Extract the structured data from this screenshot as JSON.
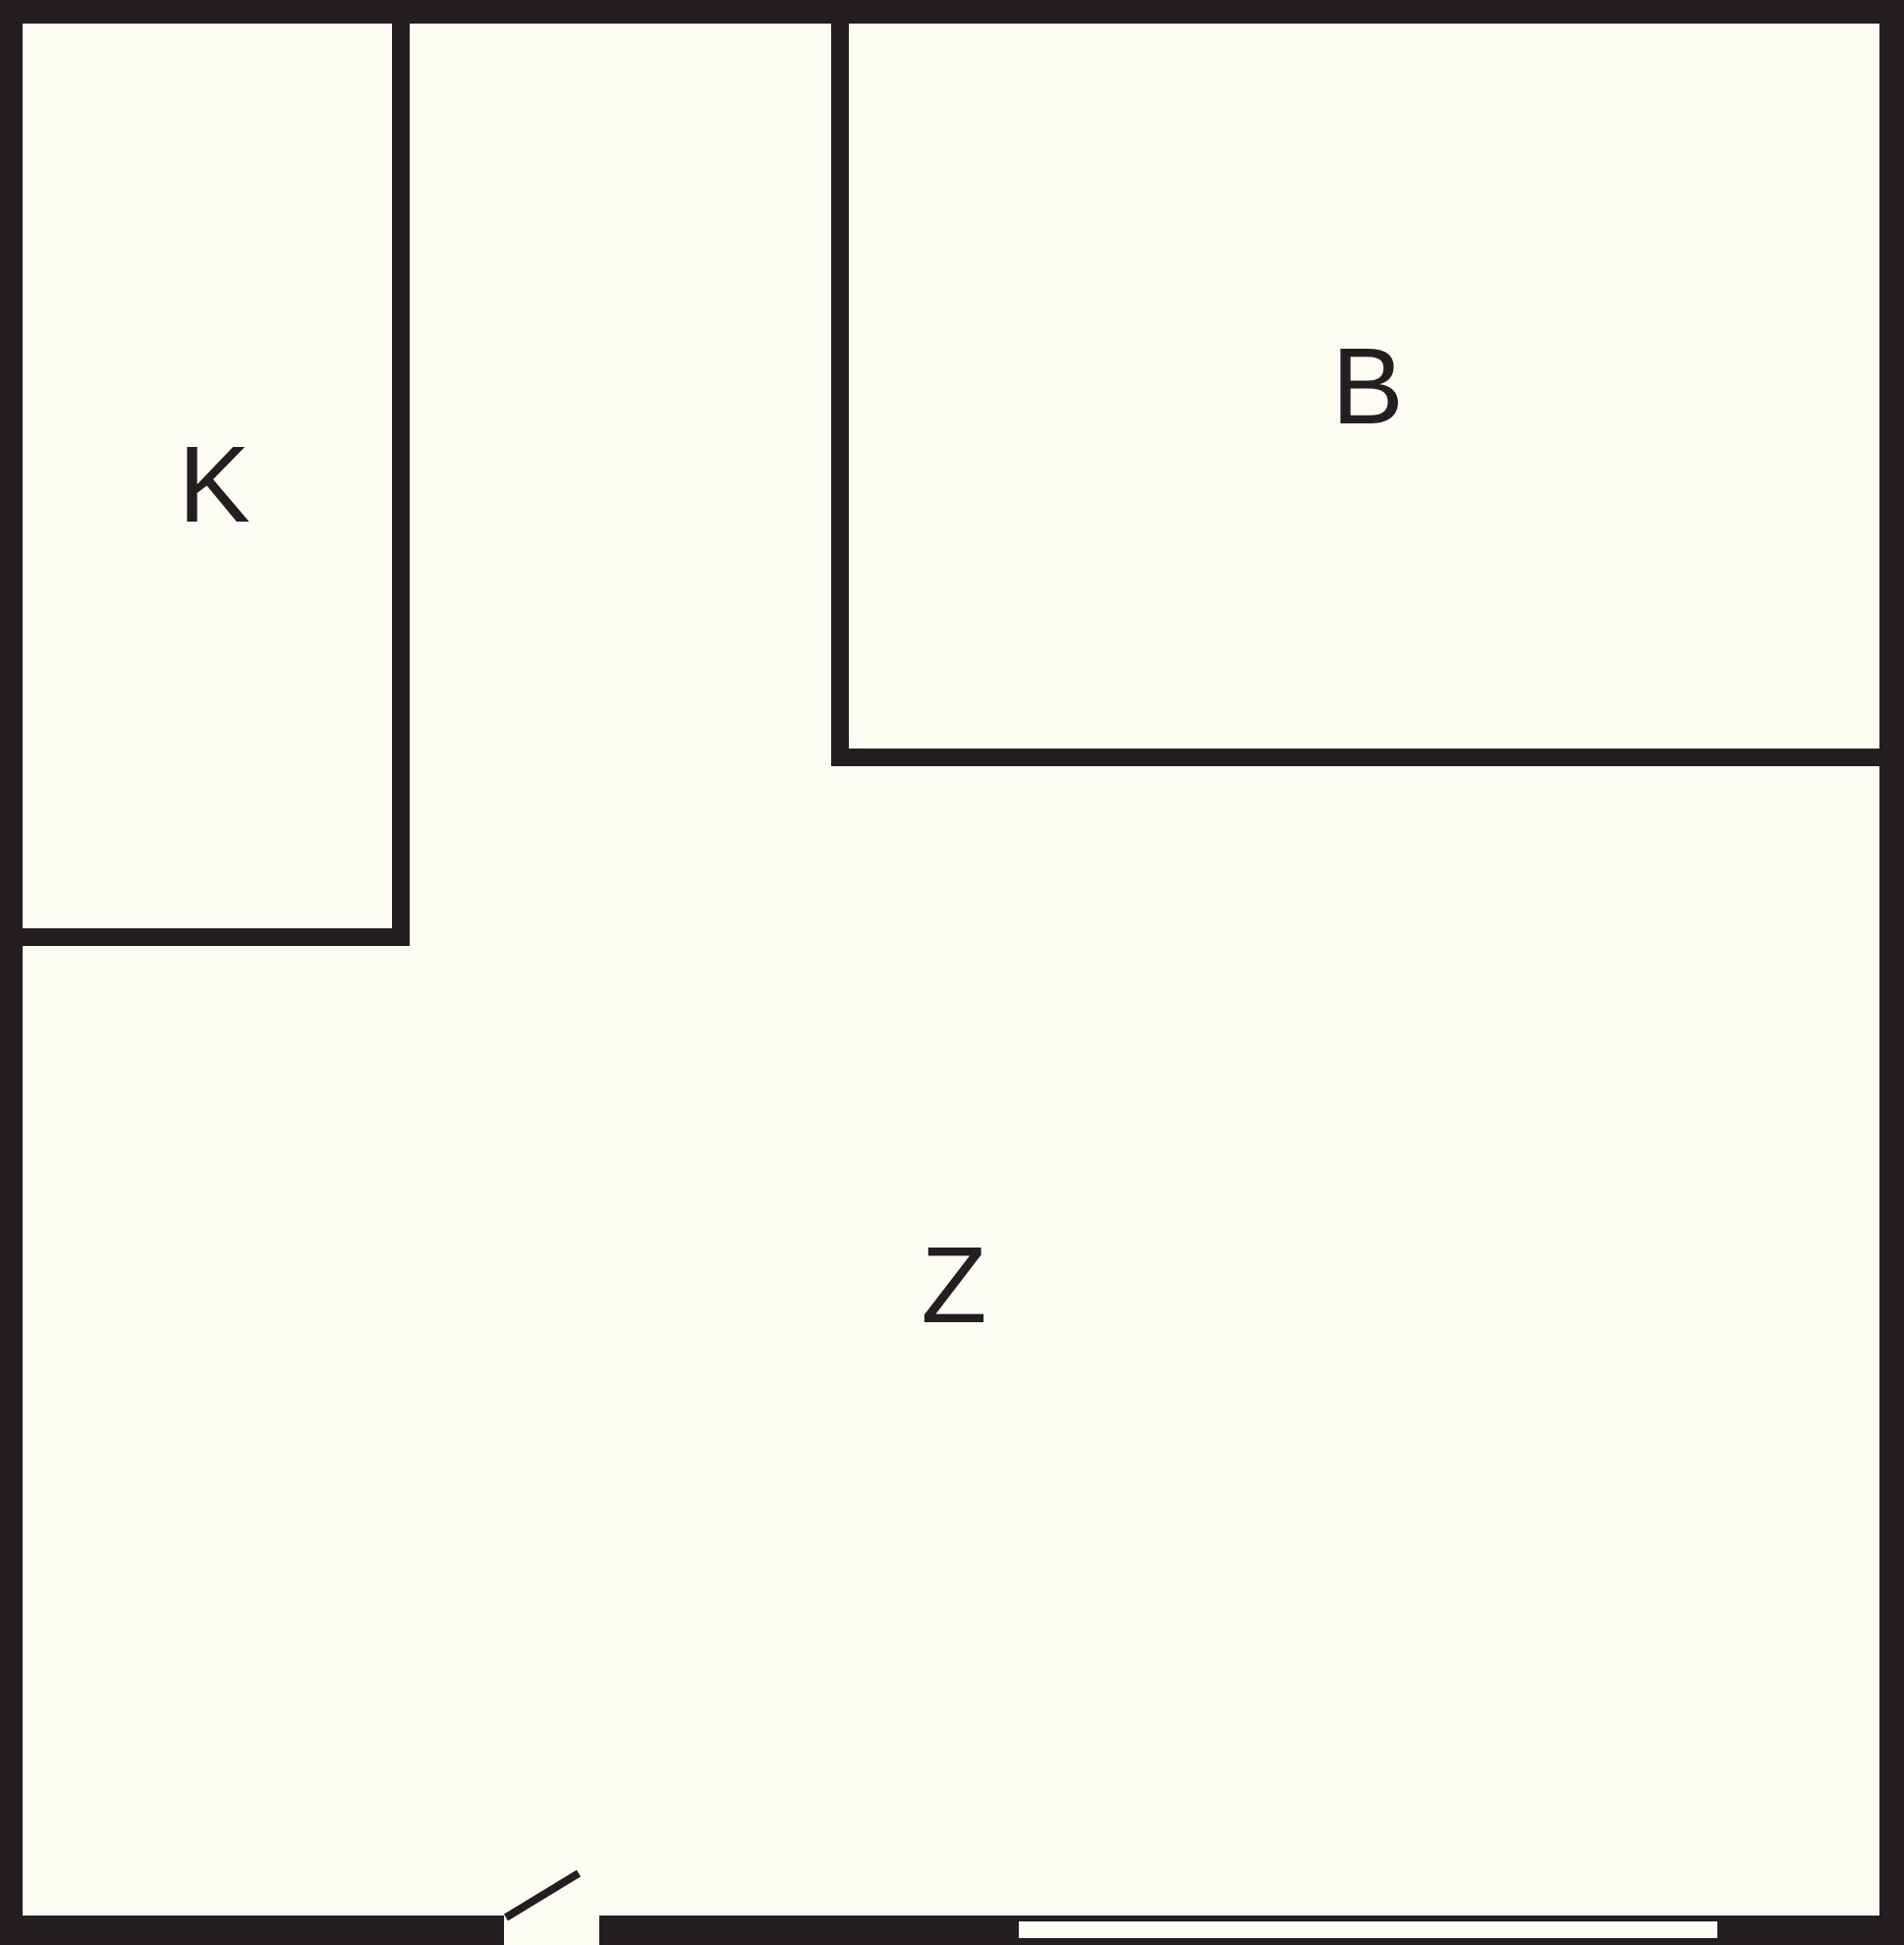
{
  "title": "Floor plan",
  "colors": {
    "wall": "#231F20",
    "background": "#FDFDF4"
  },
  "rooms": [
    {
      "id": "k",
      "label": "K"
    },
    {
      "id": "b",
      "label": "B"
    },
    {
      "id": "z",
      "label": "Z"
    }
  ],
  "features": {
    "door": "door-swing-icon",
    "window": "window-icon"
  }
}
